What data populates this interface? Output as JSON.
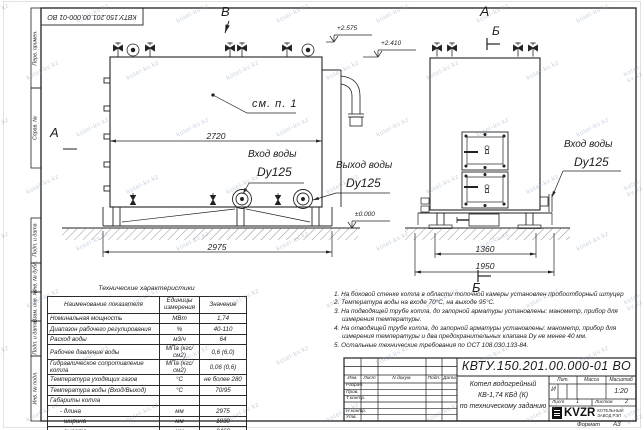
{
  "title_block": {
    "doc_number": "КВТУ.150.201.00.000-01 ВО",
    "header_cols": [
      "Изм.",
      "Лист",
      "N докум.",
      "Подп.",
      "Дата"
    ],
    "row_labels": [
      "Разраб.",
      "Пров.",
      "Т.контр.",
      "Н.контр.",
      "Утв."
    ],
    "description_lines": [
      "Котел водогрейный",
      "КВ-1,74 КБд (К)",
      "по техническому заданию"
    ],
    "lit_label": "Лит.",
    "mass_label": "Масса",
    "scale_label": "Масштаб",
    "lit_value": "И",
    "scale_value": "1:20",
    "sheet_label": "Лист",
    "sheet_value": "1",
    "sheets_label": "Листов",
    "sheets_value": "2",
    "logo_text": "KVZR",
    "logo_sub1": "КОТЕЛЬНЫЙ",
    "logo_sub2": "ЗАВОД РЭП"
  },
  "format": {
    "label": "Формат",
    "value": "А3"
  },
  "margin_labels": [
    "Перв. примен.",
    "Справ. №",
    "Подп. и дата",
    "Инв. № дубл.",
    "Взам. инв. №",
    "Подп. и дата",
    "Инв. № подл."
  ],
  "front_view": {
    "marker_top": "В",
    "marker_left": "А",
    "elev_top": "+2.575",
    "elev_mid": "+2.410",
    "elev_zero": "±0.000",
    "callout": "см. п. 1",
    "dim_body": "2720",
    "dim_base": "2975",
    "inlet_label": "Вход воды",
    "inlet_dn": "Dy125",
    "outlet_label": "Выход воды",
    "outlet_dn": "Dy125"
  },
  "side_view": {
    "marker_a": "А",
    "marker_b_top": "Б",
    "marker_b_bottom": "Б",
    "dim_inner": "1360",
    "dim_outer": "1950",
    "inlet_label": "Вход воды",
    "inlet_dn": "Dy125"
  },
  "spec_table": {
    "title": "Технические характеристики",
    "headers": [
      "Наименование показателя",
      "Единицы измерения",
      "Значение"
    ],
    "rows": [
      [
        "Номинальная мощность",
        "МВт",
        "1,74"
      ],
      [
        "Диапазон рабочего регулирования",
        "%",
        "40-110"
      ],
      [
        "Расход воды",
        "м3/ч",
        "64"
      ],
      [
        "Рабочее давление воды",
        "МПа (кгс/см2)",
        "0,6 (6,0)"
      ],
      [
        "Гидравлическое сопротивление котла",
        "МПа (кгс/см2)",
        "0,06 (0,6)"
      ],
      [
        "Температура уходящих газов",
        "°С",
        "не более 280"
      ],
      [
        "Температура воды (Вход/Выход)",
        "°С",
        "70/95"
      ],
      [
        "Габариты котла",
        "",
        ""
      ],
      [
        "- длина",
        "мм",
        "2975"
      ],
      [
        "- ширина",
        "мм",
        "1830"
      ],
      [
        "- высота",
        "мм",
        "2460"
      ]
    ]
  },
  "notes": [
    "1. На боковой стенке котла в области топочной камеры установлен пробоотборный штуцер",
    "2. Температура воды на входе 70°С, на выходе 95°С.",
    "3. На подводящей трубе котла, до запорной арматуры установлены: манометр, прибор для измерения температуры.",
    "4. На отводящей трубе котла, до запорной арматуры установлены: манометр, прибор для измерения температуры и два предохранительных клапана Dу не менее 40 мм.",
    "5. Остальные технические требования по ОСТ 108.030.133-84."
  ],
  "watermark": {
    "text": "kotel-kv.kz"
  }
}
